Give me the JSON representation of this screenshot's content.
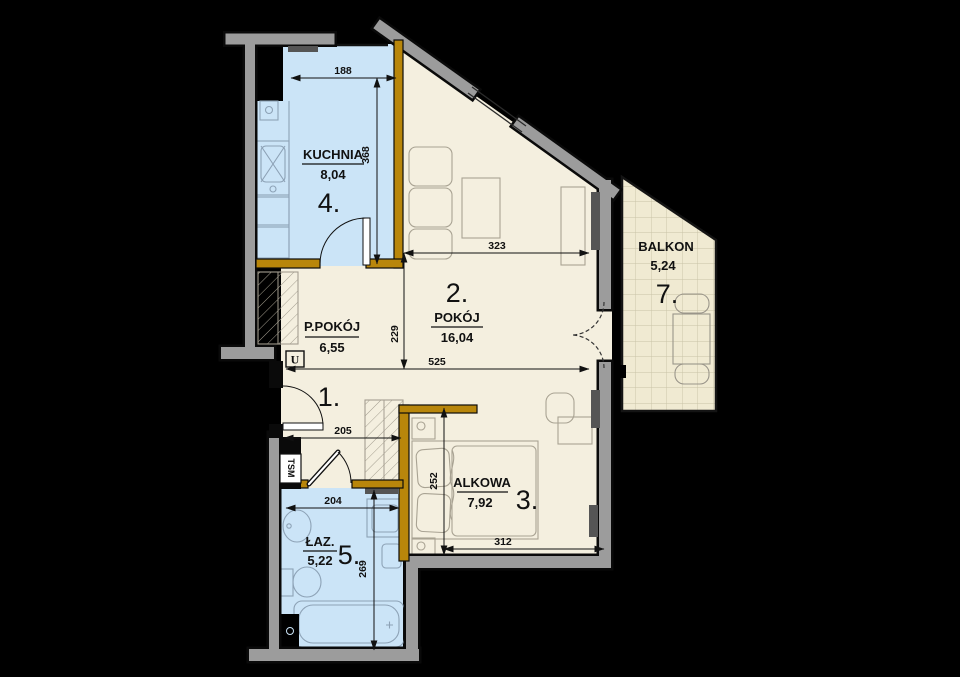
{
  "plan": {
    "rooms": {
      "kitchen": {
        "number": "4.",
        "name": "KUCHNIA",
        "area": "8,04"
      },
      "living": {
        "number": "2.",
        "name": "POKÓJ",
        "area": "16,04"
      },
      "hall": {
        "number": "1.",
        "name": "P.POKÓJ",
        "area": "6,55"
      },
      "alcove": {
        "number": "3.",
        "name": "ALKOWA",
        "area": "7,92"
      },
      "bathroom": {
        "number": "5.",
        "name": "ŁAZ.",
        "area": "5,22"
      },
      "balcony": {
        "number": "7.",
        "name": "BALKON",
        "area": "5,24"
      }
    },
    "dimensions": {
      "kitchen_width": "188",
      "kitchen_height": "368",
      "living_width": "323",
      "living_height": "229",
      "living_hall_width": "525",
      "hall_width": "205",
      "bath_width": "204",
      "bath_height": "269",
      "alcove_height": "252",
      "alcove_width": "312"
    },
    "annotations": {
      "utility": "U",
      "shaft": "TSM"
    },
    "colors": {
      "background": "#000000",
      "wet_room_floor": "#cbe4f7",
      "room_floor": "#f4efdf",
      "balcony_floor": "#f0ead2",
      "wall_gray": "#9c9c9c",
      "wall_partition": "#b8860b",
      "window_bar": "#555555"
    }
  }
}
